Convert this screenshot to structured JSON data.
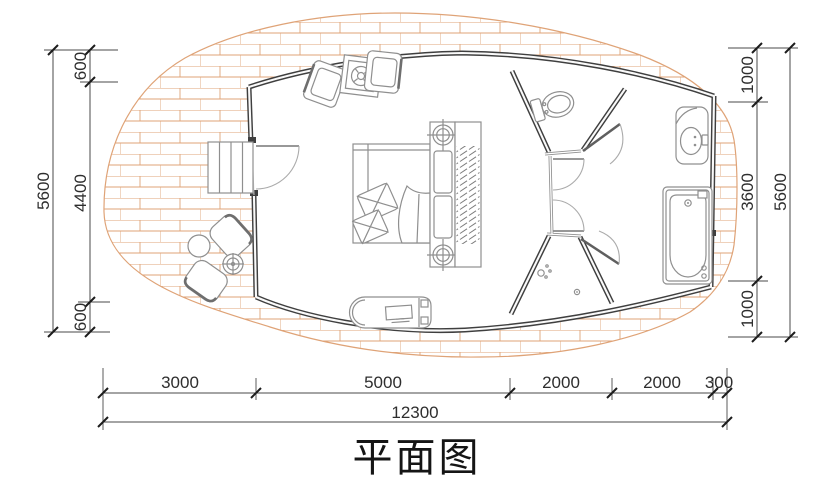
{
  "title": "平面图",
  "dimensions": {
    "left": {
      "total": "5600",
      "segments": [
        "600",
        "4400",
        "600"
      ]
    },
    "right": {
      "total": "5600",
      "segments": [
        "1000",
        "3600",
        "1000"
      ]
    },
    "bottom": {
      "total": "12300",
      "segments": [
        "3000",
        "5000",
        "2000",
        "2000",
        "300"
      ]
    }
  },
  "colors": {
    "brick": "#DFA377",
    "wall": "#3F3F3F",
    "partition": "#8F8F8F",
    "furniture": "#8F8F8F",
    "dim": "#4A4A4A",
    "background": "#FFFFFF"
  },
  "fixtures": [
    "brick-paved-deck",
    "entry-steps",
    "entry-door",
    "armchair",
    "armchair",
    "coffee-table",
    "double-bed",
    "pillows",
    "duvet",
    "nightstand-lamps",
    "wardrobe",
    "tv-cabinet",
    "outdoor-chair",
    "outdoor-chair",
    "outdoor-round-table",
    "outdoor-side-table",
    "toilet",
    "toilet-room",
    "shower-room",
    "shower-head",
    "floor-drain",
    "wash-basin",
    "bathtub"
  ]
}
